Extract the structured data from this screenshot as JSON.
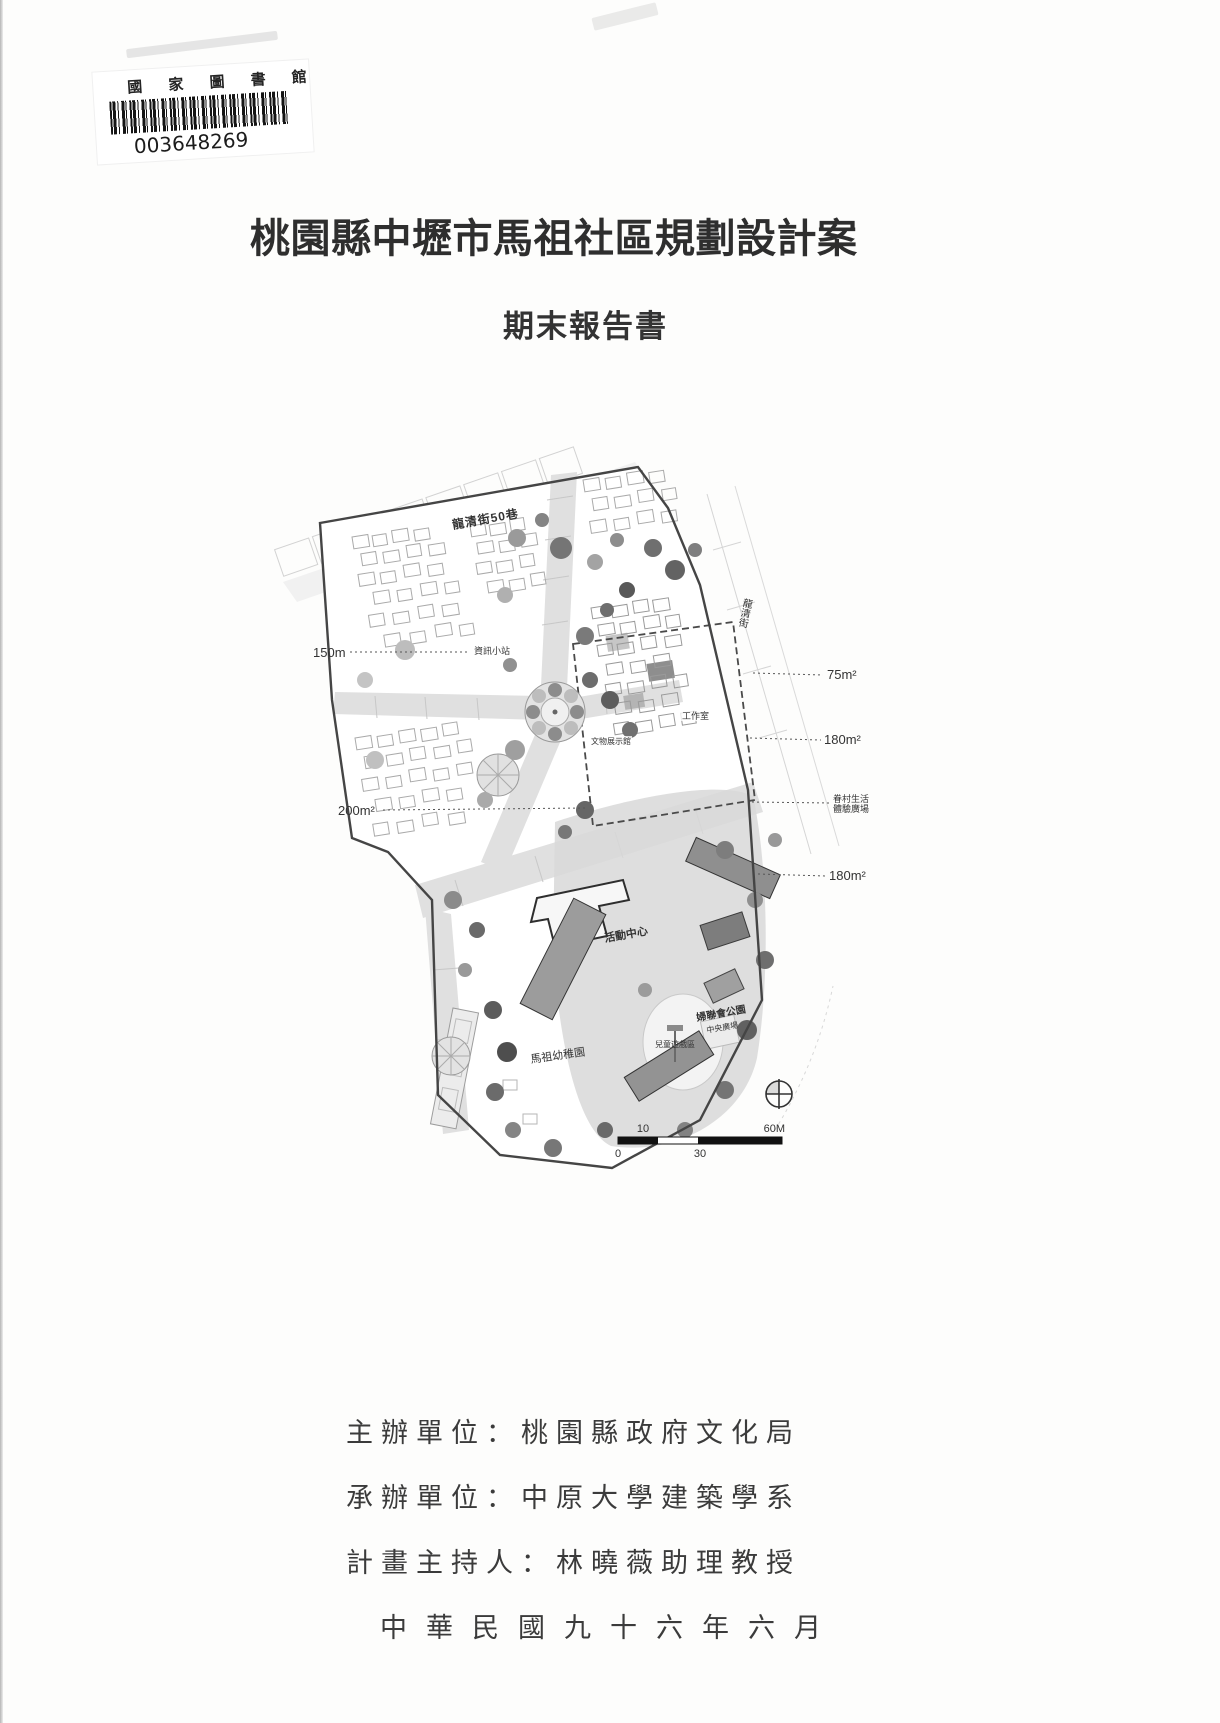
{
  "colors": {
    "ink": "#2f2f2f",
    "paper": "#fdfdfc",
    "map_dark": "#4a4a4a"
  },
  "library_card": {
    "institution": "國 家 圖 書 館",
    "barcode_number": "003648269"
  },
  "title": "桃園縣中壢市馬祖社區規劃設計案",
  "subtitle": "期末報告書",
  "map": {
    "street_top": "龍清街50巷",
    "street_right": "龍清街",
    "labels": {
      "info_station": "資訊小站",
      "workshop": "工作室",
      "artifact_hall": "文物展示館",
      "activity_center": "活動中心",
      "kindergarten": "馬祖幼稚園",
      "park": "婦聯會公園",
      "central_plaza": "中央廣場",
      "children_play": "兒童遊戲區"
    },
    "annotations": {
      "left_150m": "150m",
      "left_200m2": "200m²",
      "right_75m2": "75m²",
      "right_180m2_a": "180m²",
      "veteran_line1": "眷村生活",
      "veteran_line2": "體驗廣場",
      "right_180m2_b": "180m²"
    },
    "scale_bar": {
      "label_10": "10",
      "label_60m": "60M",
      "label_0": "0",
      "label_30": "30"
    }
  },
  "footer": {
    "lines": [
      "主辦單位：桃園縣政府文化局",
      "承辦單位：中原大學建築學系",
      "計畫主持人：林曉薇助理教授",
      "中華民國九十六年六月"
    ]
  }
}
